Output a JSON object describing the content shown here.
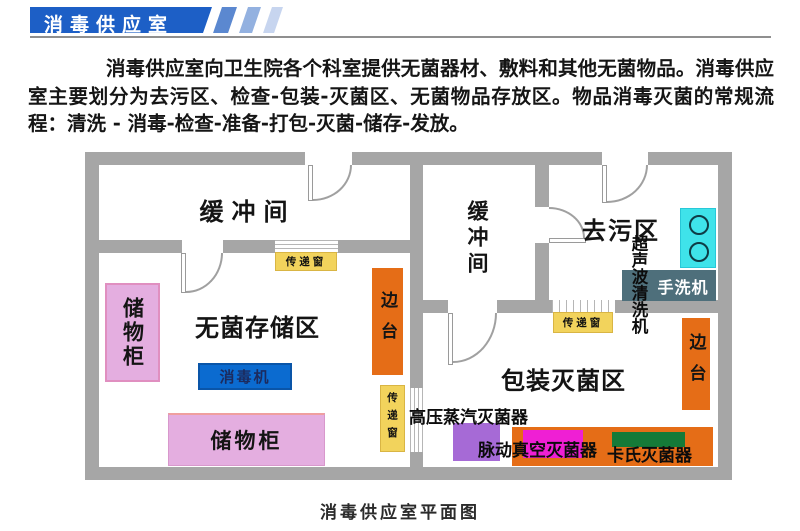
{
  "palette": {
    "banner_blue": "#1d5fc6",
    "stripe_blue_1": "#5b88d0",
    "stripe_blue_2": "#93b1e0",
    "stripe_blue_3": "#c7d5ef",
    "wall_gray": "#a6a6a6",
    "cabinet_pink": "#e4aee0",
    "disinfector_blue": "#0b6bd0",
    "side_table_orange": "#e56d17",
    "transfer_window_yellow": "#f2d35c",
    "sink_cyan": "#3fe3ea",
    "hand_washer_slate": "#4e6f7b",
    "autoclave_purple": "#a66ad6",
    "pulse_vacuum_magenta": "#ef1fd4",
    "cassette_green": "#157a38"
  },
  "header": {
    "title": "消毒供应室"
  },
  "intro": {
    "text": "消毒供应室向卫生院各个科室提供无菌器材、敷料和其他无菌物品。消毒供应室主要划分为去污区、检查-包装-灭菌区、无菌物品存放区。物品消毒灭菌的常规流程：清洗 - 消毒-检查-准备-打包-灭菌-储存-发放。"
  },
  "plan": {
    "caption": "消毒供应室平面图",
    "rooms": {
      "buffer_left": "缓冲间",
      "buffer_mid": "缓冲间",
      "decontamination": "去污区",
      "sterile_storage": "无菌存储区",
      "packing_sterilization": "包装灭菌区"
    },
    "items": {
      "cabinet_left": "储物柜",
      "cabinet_bottom": "储物柜",
      "disinfector": "消毒机",
      "side_table_left": "边台",
      "side_table_right": "边台",
      "ultrasonic_cleaner": "超声波清洗机",
      "hand_washer": "手洗机",
      "autoclave": "高压蒸汽灭菌器",
      "pulse_vacuum_sterilizer": "脉动真空灭菌器",
      "cassette_sterilizer": "卡氏灭菌器",
      "transfer_window_top": "传递窗",
      "transfer_window_mid": "传递窗",
      "transfer_window_right": "传递窗"
    }
  }
}
